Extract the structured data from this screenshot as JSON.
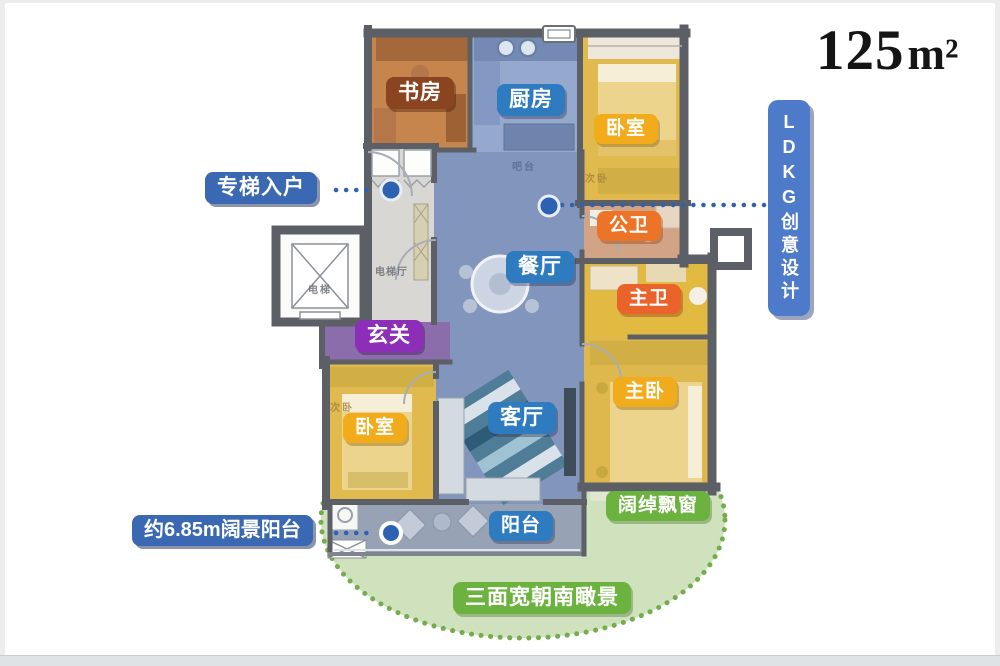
{
  "area_label": {
    "number": "125",
    "unit": "m²"
  },
  "feature_badges": {
    "ldkg": "LDKG创意设计",
    "private_elevator": "专梯入户",
    "wide_balcony": "约6.85m阔景阳台",
    "bay_window": "阔绰飘窗",
    "south_view": "三面宽朝南瞰景"
  },
  "room_labels": {
    "study": "书房",
    "kitchen": "厨房",
    "bedroom_top": "卧室",
    "public_bath": "公卫",
    "dining": "餐厅",
    "master_bath": "主卫",
    "foyer": "玄关",
    "master_bedroom": "主卧",
    "bedroom_left": "卧室",
    "living": "客厅",
    "balcony": "阳台"
  },
  "plan_texts": {
    "elevator": "电梯",
    "elevator_hall": "电梯厅",
    "bar_counter": "吧台",
    "secondary_bedroom_right": "次卧",
    "secondary_bedroom_left": "次卧"
  },
  "colors": {
    "wall": "#5c6066",
    "blue_room_label": "#2f7bc0",
    "navy_feature_label": "#3a68b2",
    "ldkg_label": "#4d7ac9",
    "gold_label": "#f1ab1b",
    "orange_label": "#ed7426",
    "deep_orange_label": "#e9632b",
    "purple_label": "#8d2eb8",
    "brown_label": "#8a4420",
    "green_label": "#6cb23e",
    "green_zone_fill": "#cfe1bd",
    "dotted_leader_blue": "#2d62b2"
  }
}
